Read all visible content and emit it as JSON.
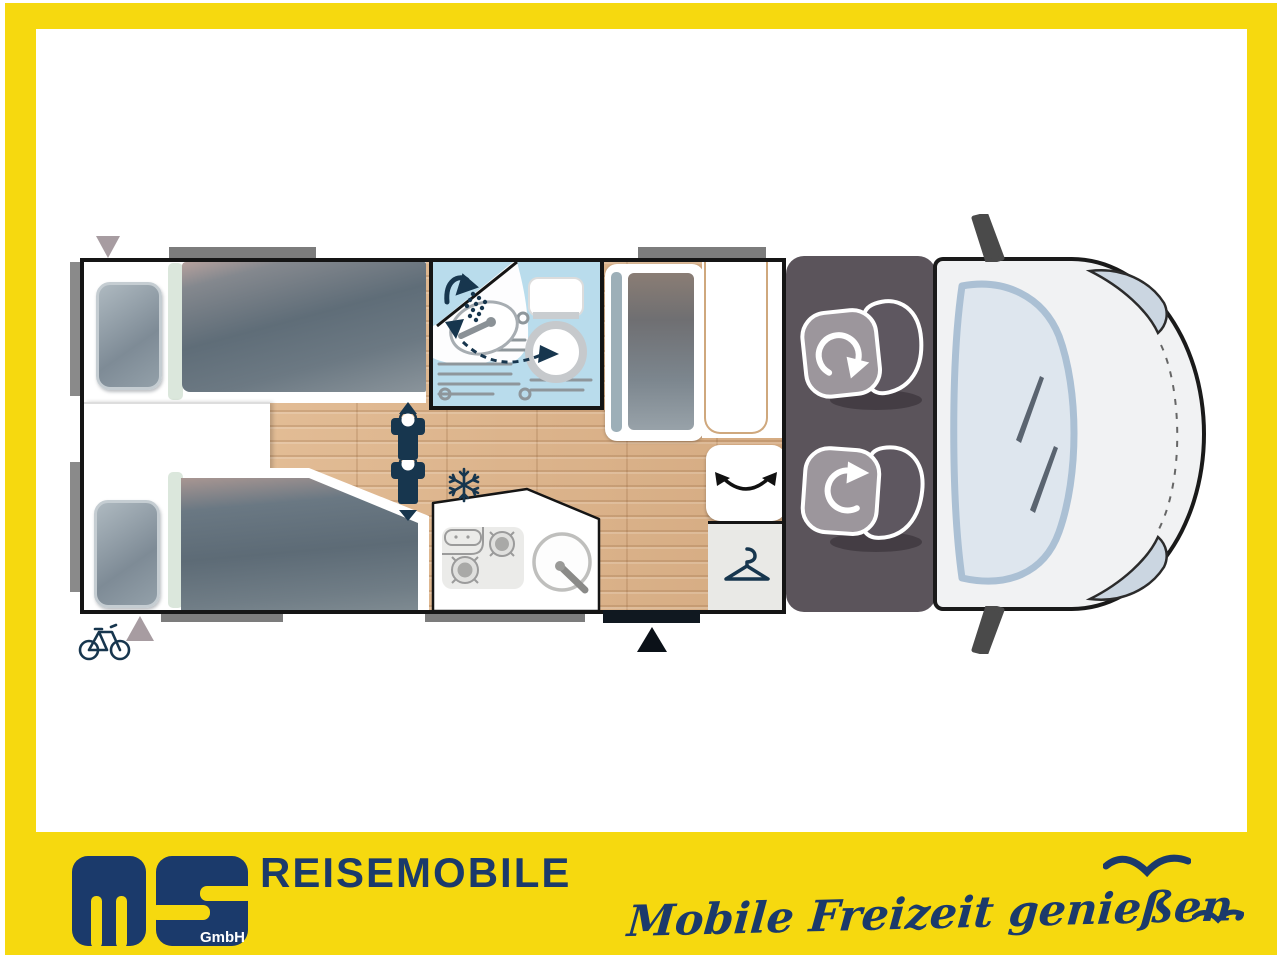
{
  "image_type": "motorhome-floorplan-advert",
  "banner": {
    "logo_main": "ms",
    "logo_sub": "GmbH",
    "title": "REISEMOBILE",
    "slogan": "Mobile Freizeit genießen.",
    "background": "#F6D90F",
    "text_color": "#1B3A6B",
    "icons": [
      "seagull-icon-large",
      "seagull-icon-small"
    ]
  },
  "floorplan": {
    "description": "top view of semi-integrated motorhome, cab at right, rear at left",
    "colors": {
      "bathroom_blue": "#B9DCEC",
      "wood_floor": "#DCB58E",
      "icon_navy": "#17364E",
      "cab_floor_gray": "#5B545B",
      "duvet_gray": "#5F6D78",
      "outline_black": "#151515",
      "window_marker_gray": "#7C7C7C",
      "marker_triangle_gray": "#A79CA1",
      "table_trim_tan": "#CFA87D"
    },
    "rooms": {
      "rear_bedroom": {
        "name": "twin-single-beds",
        "features": [
          "pillow",
          "duvet",
          "center-step"
        ]
      },
      "bathroom": {
        "name": "shower-washroom",
        "features": [
          "shower-icon",
          "washbasin",
          "swivel-toilet",
          "dashed-swivel-arrow",
          "drain-grate"
        ]
      },
      "kitchen": {
        "name": "kitchen-block",
        "features": [
          "two-burner-hob",
          "round-sink",
          "faucet"
        ],
        "burner_count": "2"
      },
      "lounge": {
        "name": "dinette",
        "features": [
          "bench-seat",
          "table",
          "swivel-stool-arrow"
        ]
      },
      "wardrobe": {
        "name": "wardrobe",
        "features": [
          "hanger-icon"
        ]
      },
      "cab": {
        "name": "driver-cab",
        "features": [
          "swivel-driver-seat",
          "swivel-passenger-seat",
          "windshield",
          "wipers",
          "headlights",
          "mirrors",
          "hood-dash-line"
        ]
      }
    },
    "markers": [
      "bike-storage-icon",
      "rear-marker-triangle-top",
      "rear-marker-triangle-bottom",
      "entry-door-triangle",
      "berth-person-icon-up",
      "berth-person-icon-down",
      "snowflake-fridge-icon",
      "window-bars"
    ]
  }
}
